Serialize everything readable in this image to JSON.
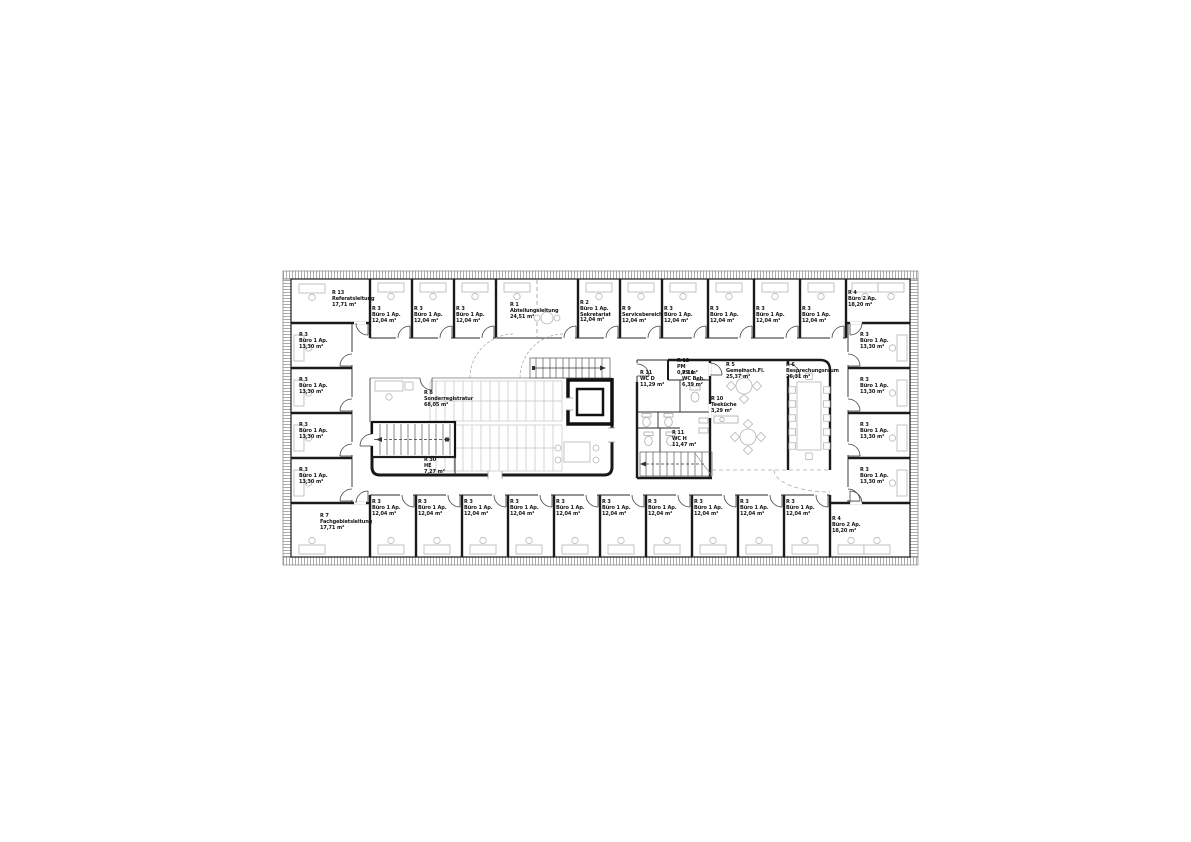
{
  "sheet": {
    "background": "#ffffff",
    "wall_color": "#1a1a1a",
    "furniture_color": "#b5b5b5",
    "facade_tick_color": "#8a8a8a"
  },
  "rooms": {
    "top": [
      {
        "id": "R 13",
        "name": "Referatsleitung",
        "area": "17,71 m²"
      },
      {
        "id": "R 3",
        "name": "Büro 1 Ap.",
        "area": "12,04 m²"
      },
      {
        "id": "R 3",
        "name": "Büro 1 Ap.",
        "area": "12,04 m²"
      },
      {
        "id": "R 3",
        "name": "Büro 1 Ap.",
        "area": "12,04 m²"
      },
      {
        "id": "R 1",
        "name": "Abteilungsleitung",
        "area": "24,51 m²"
      },
      {
        "id": "R 2",
        "name": "Büro 1 Ap.",
        "name2": "Sekretariat",
        "area": "12,04 m²"
      },
      {
        "id": "R 9",
        "name": "Servicebereich",
        "area": "12,04 m²"
      },
      {
        "id": "R 3",
        "name": "Büro 1 Ap.",
        "area": "12,04 m²"
      },
      {
        "id": "R 3",
        "name": "Büro 1 Ap.",
        "area": "12,04 m²"
      },
      {
        "id": "R 3",
        "name": "Büro 1 Ap.",
        "area": "12,04 m²"
      },
      {
        "id": "R 3",
        "name": "Büro 1 Ap.",
        "area": "12,04 m²"
      },
      {
        "id": "R 4",
        "name": "Büro 2 Ap.",
        "area": "18,20 m²"
      }
    ],
    "left": [
      {
        "id": "R 3",
        "name": "Büro 1 Ap.",
        "area": "13,30 m²"
      },
      {
        "id": "R 3",
        "name": "Büro 1 Ap.",
        "area": "13,30 m²"
      },
      {
        "id": "R 3",
        "name": "Büro 1 Ap.",
        "area": "13,30 m²"
      },
      {
        "id": "R 3",
        "name": "Büro 1 Ap.",
        "area": "13,30 m²"
      }
    ],
    "right": [
      {
        "id": "R 3",
        "name": "Büro 1 Ap.",
        "area": "13,30 m²"
      },
      {
        "id": "R 3",
        "name": "Büro 1 Ap.",
        "area": "13,30 m²"
      },
      {
        "id": "R 3",
        "name": "Büro 1 Ap.",
        "area": "13,30 m²"
      },
      {
        "id": "R 3",
        "name": "Büro 1 Ap.",
        "area": "13,30 m²"
      }
    ],
    "bottom": [
      {
        "id": "R 7",
        "name": "Fachgebietsleitung",
        "area": "17,71 m²"
      },
      {
        "id": "R 3",
        "name": "Büro 1 Ap.",
        "area": "12,04 m²"
      },
      {
        "id": "R 3",
        "name": "Büro 1 Ap.",
        "area": "12,04 m²"
      },
      {
        "id": "R 3",
        "name": "Büro 1 Ap.",
        "area": "12,04 m²"
      },
      {
        "id": "R 3",
        "name": "Büro 1 Ap.",
        "area": "12,04 m²"
      },
      {
        "id": "R 3",
        "name": "Büro 1 Ap.",
        "area": "12,04 m²"
      },
      {
        "id": "R 3",
        "name": "Büro 1 Ap.",
        "area": "12,04 m²"
      },
      {
        "id": "R 3",
        "name": "Büro 1 Ap.",
        "area": "12,04 m²"
      },
      {
        "id": "R 3",
        "name": "Büro 1 Ap.",
        "area": "12,04 m²"
      },
      {
        "id": "R 3",
        "name": "Büro 1 Ap.",
        "area": "12,04 m²"
      },
      {
        "id": "R 3",
        "name": "Büro 1 Ap.",
        "area": "12,04 m²"
      },
      {
        "id": "R 4",
        "name": "Büro 2 Ap.",
        "area": "18,20 m²"
      }
    ],
    "core": {
      "registratur": {
        "id": "R 8",
        "name": "Sonderregistratur",
        "area": "68,05 m²"
      },
      "he": {
        "id": "R 30",
        "name": "HE",
        "area": "7,27 m²"
      },
      "pm": {
        "id": "R 12",
        "name": "PM",
        "area": "0,79 m²"
      },
      "wc_d": {
        "id": "R 11",
        "name": "WC D",
        "area": "11,29 m²"
      },
      "wc_beh": {
        "id": "R 11",
        "name": "WC Beh.",
        "area": "6,39 m²"
      },
      "wc_h": {
        "id": "R 11",
        "name": "WC H",
        "area": "11,47 m²"
      },
      "teekueche": {
        "id": "R 10",
        "name": "Teeküche",
        "area": "3,29 m²"
      },
      "gemeinschaftsflaeche": {
        "id": "R 5",
        "name": "Gemeinsch.Fl.",
        "area": "25,37 m²"
      },
      "besprechungsraum": {
        "id": "R 6",
        "name": "Besprechungsraum",
        "area": "26,31 m²"
      }
    }
  }
}
